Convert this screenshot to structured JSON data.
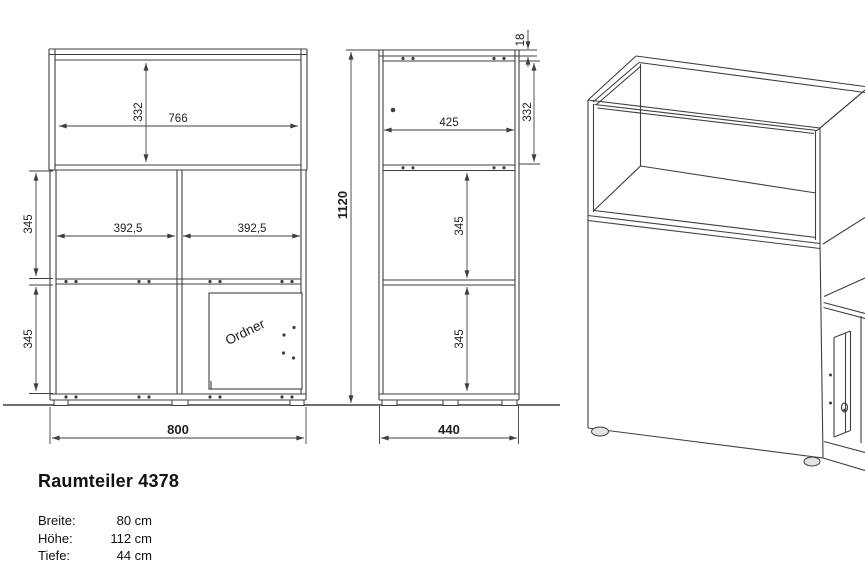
{
  "product": {
    "title": "Raumteiler 4378",
    "specs": [
      {
        "label": "Breite:",
        "value": "80 cm"
      },
      {
        "label": "Höhe:",
        "value": "112 cm"
      },
      {
        "label": "Tiefe:",
        "value": "44 cm"
      }
    ]
  },
  "front_view": {
    "labels": {
      "top_inner_height": "332",
      "inner_width": "766",
      "upper_compartment_height": "345",
      "lower_compartment_height": "345",
      "left_compartment_width": "392,5",
      "right_compartment_width": "392,5",
      "total_width": "800",
      "door": "Ordner"
    }
  },
  "side_view": {
    "labels": {
      "top_panel_thickness": "18",
      "top_inner_height": "332",
      "inner_depth": "425",
      "upper_compartment_height": "345",
      "lower_compartment_height": "345",
      "total_height": "1120",
      "total_depth": "440"
    }
  },
  "colors": {
    "line": "#3f3f3f",
    "text": "#1f1f1f",
    "background": "#ffffff"
  }
}
